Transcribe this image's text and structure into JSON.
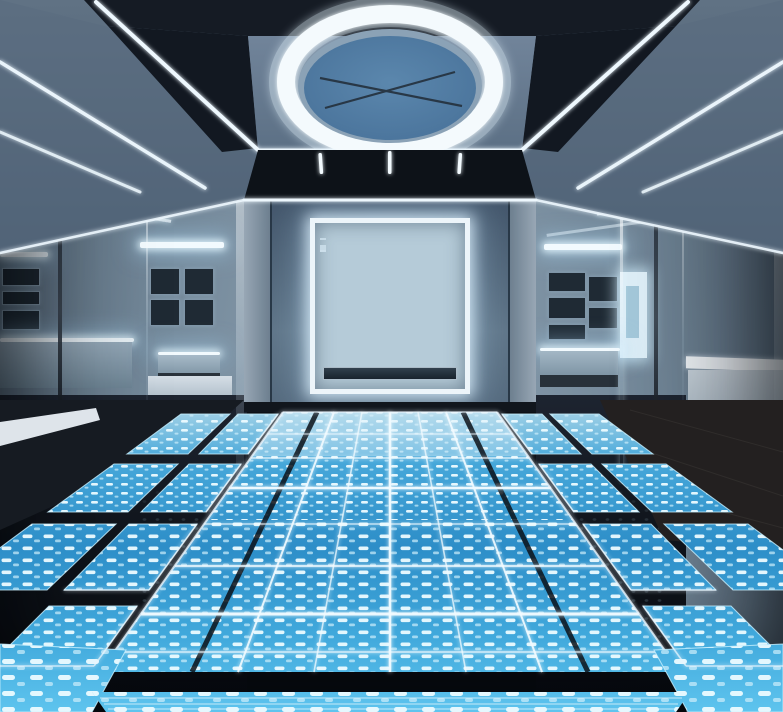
{
  "meta": {
    "scene_title": "Futuristic gallery room with illuminated LED data floor",
    "scene_type": "photorealistic interior render",
    "width_px": 783,
    "height_px": 712
  },
  "scene": {
    "ceiling": {
      "feature": "large circular ring light with steel-blue inner disc and thin X-shaped crossing lines",
      "hanging_tube_lights": 3,
      "led_strip_beams_left": 3,
      "led_strip_beams_right": 3
    },
    "back_wall": {
      "feature": "square backlit display case with glowing white frame",
      "display_case_rows": 6,
      "cove_light": "white LED line along top of wall continuing to both side walls"
    },
    "left_room": {
      "pictures_cluster_a": 3,
      "pictures_cluster_b": 4,
      "display_table": 1,
      "counter": 1,
      "ceiling_light_bars": 2
    },
    "right_room": {
      "pictures_cluster_a": 3,
      "pictures_cluster_b": 2,
      "backlit_panel": 1,
      "display_table": 1,
      "white_counter": 1,
      "ceiling_light_bars": 1
    },
    "floor": {
      "feature": "glowing blue LED tile floor with white dot-matrix dashes and perspective grid lines",
      "central_walkway_grid_lines": 5,
      "side_panel_rows_left": 4,
      "side_panel_rows_right": 4,
      "front_panel_row": 1
    }
  },
  "display_case": {
    "rows": [
      {
        "h": 20,
        "items": 4
      },
      {
        "h": 25,
        "items": 5
      },
      {
        "h": 24,
        "items": 5
      },
      {
        "h": 25,
        "items": 4
      },
      {
        "h": 22,
        "items": 5
      },
      {
        "h": 13,
        "items": 7
      }
    ]
  },
  "palette": {
    "ceiling_base": "#53657a",
    "ceiling_panel": "#6b7e93",
    "ceiling_dark_band": "#151b24",
    "ring_white": "#f4fafd",
    "ring_disc_blue": "#4f7ba2",
    "soffit_dark": "#0d1218",
    "back_wall_top": "#42556a",
    "back_wall_bottom": "#5f7588",
    "case_frame_white": "#edf5fa",
    "case_inner_blue": "#b5cbd8",
    "artifact_dark": "#1f2a34",
    "glass_tint": "#7e94a6",
    "counter_white": "#d5dee6",
    "led_strip_white": "#eef8fe",
    "floor_blue": "#2f8fc9",
    "floor_blue_bright": "#5ec4ee",
    "floor_dot_white": "#ecfaff",
    "floor_gap_dark": "#0c1016",
    "wood_floor_dark": "#232020"
  }
}
